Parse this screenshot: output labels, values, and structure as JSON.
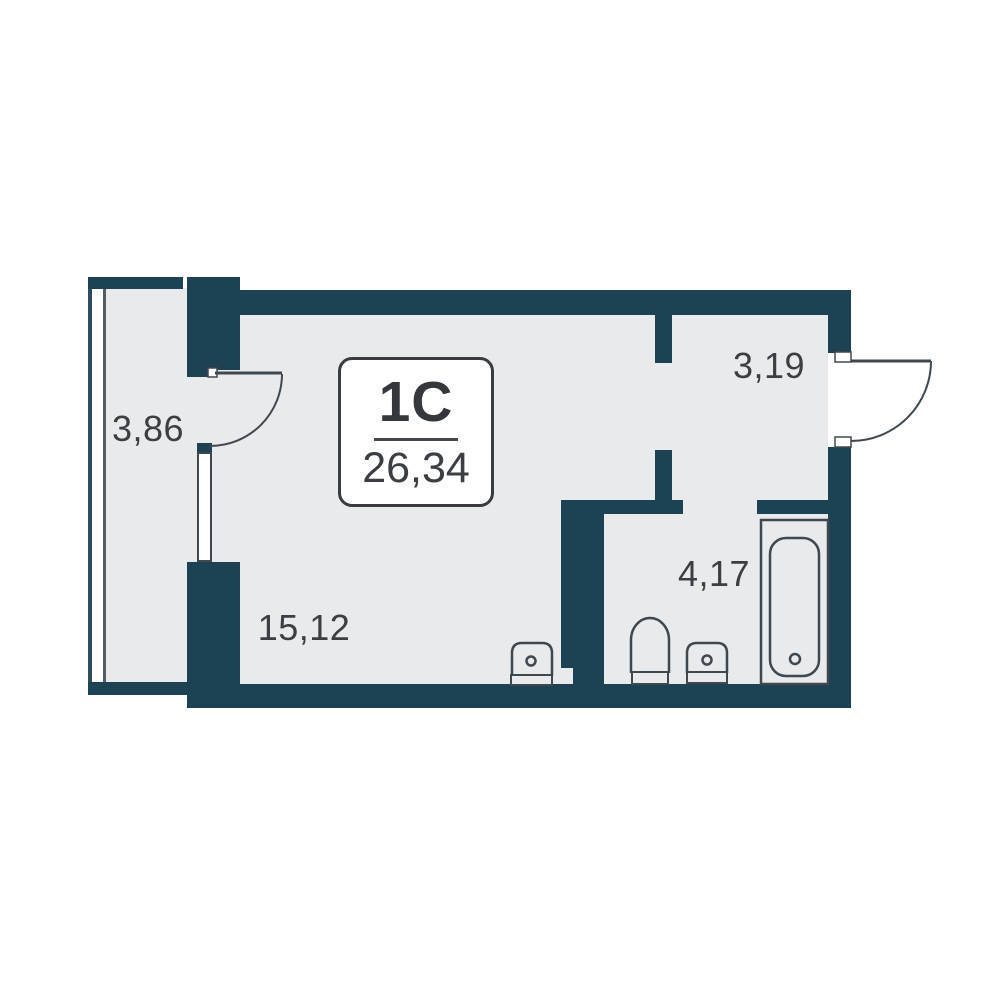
{
  "unit": {
    "type_label": "1С",
    "area_label": "26,34"
  },
  "rooms": [
    {
      "id": "balcony",
      "area_label": "3,86"
    },
    {
      "id": "hallway",
      "area_label": "3,19"
    },
    {
      "id": "living",
      "area_label": "15,12"
    },
    {
      "id": "bathroom",
      "area_label": "4,17"
    }
  ],
  "fixtures": [
    "bathtub",
    "toilet",
    "bathroom-sink",
    "kitchen-sink",
    "balcony-door",
    "entrance-door"
  ],
  "colors": {
    "wall": "#1d4254",
    "floor": "#e9eaec",
    "line": "#40484f",
    "text": "#3b3e43",
    "bg": "#ffffff"
  }
}
